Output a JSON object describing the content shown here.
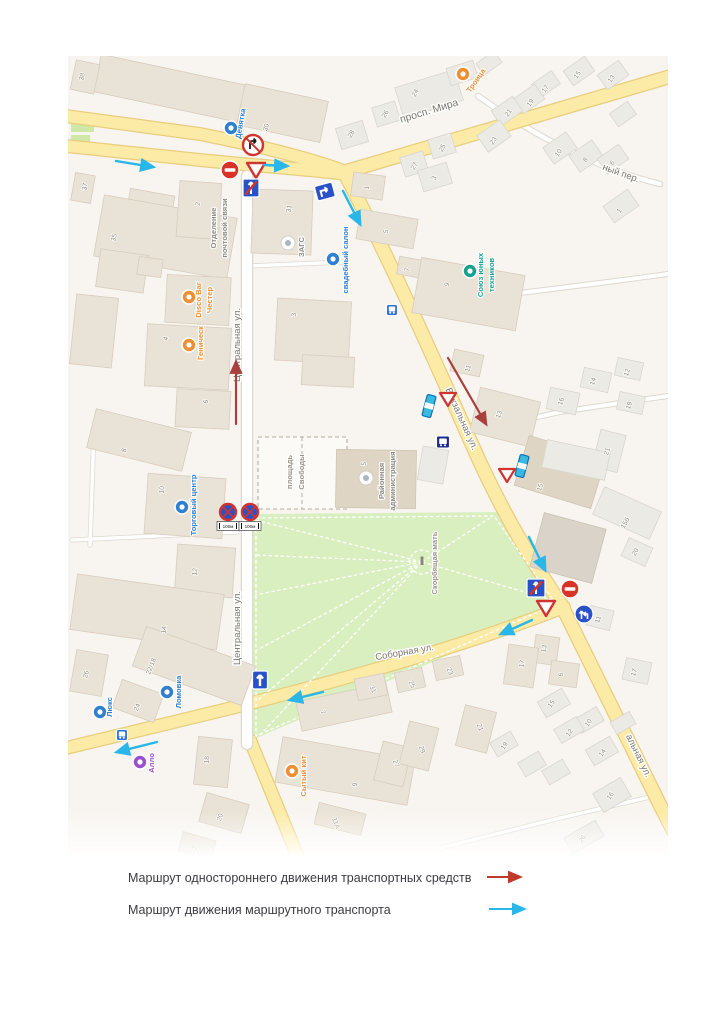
{
  "map": {
    "streets": {
      "prosp_mira": "просп. Мира",
      "vokzalnaya": "Вокзальная ул.",
      "centralnaya": "Центральная ул.",
      "sobornaya": "Соборная ул.",
      "pereulok_partial": "ный пер.",
      "vokzalnaya_partial": "альная ул."
    },
    "pois": {
      "devyatka": {
        "label": "Девятка",
        "color": "#2f80d0"
      },
      "troitsa": {
        "label": "Троица",
        "color": "#ee8f33"
      },
      "post_office": {
        "label1": "Отделение",
        "label2": "почтовой связи"
      },
      "zags": {
        "label": "ЗАГС"
      },
      "wedding_salon": {
        "label": "свадебный салон",
        "color": "#2f80d0"
      },
      "disco_bar": {
        "label1": "Disco Bar",
        "label2": "Честер",
        "color": "#ee8f33"
      },
      "genichesk": {
        "label": "Геническ",
        "color": "#ee8f33"
      },
      "shopping_center": {
        "label": "Торговый центр",
        "color": "#2f80d0"
      },
      "young_technicians": {
        "label1": "Союз юных",
        "label2": "техников",
        "color": "#18a18f"
      },
      "administration": {
        "label1": "Районная",
        "label2": "администрация"
      },
      "freedom_square": {
        "label1": "площадь",
        "label2": "Свободы"
      },
      "monument": {
        "label": "Скорбящая мать"
      },
      "lyuks": {
        "label": "Люкс",
        "color": "#2f80d0"
      },
      "lomovka": {
        "label": "Ломовка",
        "color": "#2f80d0"
      },
      "allo": {
        "label": "Алло",
        "color": "#9a4fd0"
      },
      "sytyi_kit": {
        "label": "Сытый кит",
        "color": "#ee8f33"
      }
    },
    "building_numbers": [
      "38",
      "37",
      "35",
      "2",
      "31",
      "30",
      "24",
      "26",
      "28",
      "15",
      "13",
      "17",
      "19",
      "21",
      "23",
      "10",
      "8",
      "6",
      "1",
      "25",
      "27",
      "1",
      "3",
      "5",
      "3",
      "4",
      "6",
      "8",
      "10",
      "12",
      "14",
      "22/18",
      "26",
      "24",
      "18",
      "20",
      "22",
      "5",
      "7",
      "9",
      "11",
      "13",
      "15",
      "14",
      "16",
      "12",
      "19",
      "21",
      "15б",
      "20",
      "11",
      "13",
      "17",
      "6",
      "17",
      "7",
      "31",
      "25",
      "23",
      "27",
      "29",
      "21",
      "9",
      "11А",
      "15",
      "10",
      "12",
      "14",
      "19",
      "16",
      "26"
    ],
    "plates": {
      "zone_length": "100м"
    },
    "signs": {
      "no_entry": "no-entry",
      "give_way": "give-way-triangle",
      "no_right_turn": "no-right-turn",
      "one_way": "one-way-up-arrow",
      "one_way_end": "one-way-end",
      "no_stopping": "no-stopping",
      "mandatory_direction": "blue-circle-arrows",
      "bus_stop": "bus-stop",
      "lane_sign": "striped-lane-sign"
    },
    "route_colors": {
      "one_way_traffic": "#a8403e",
      "public_transport": "#29b6e8"
    }
  },
  "legend": {
    "items": [
      {
        "label": "Маршрут одностороннего движения  транспортных средств",
        "color": "#c0392b"
      },
      {
        "label": "Маршрут движения маршрутного транспорта",
        "color": "#29b6e8"
      }
    ]
  }
}
